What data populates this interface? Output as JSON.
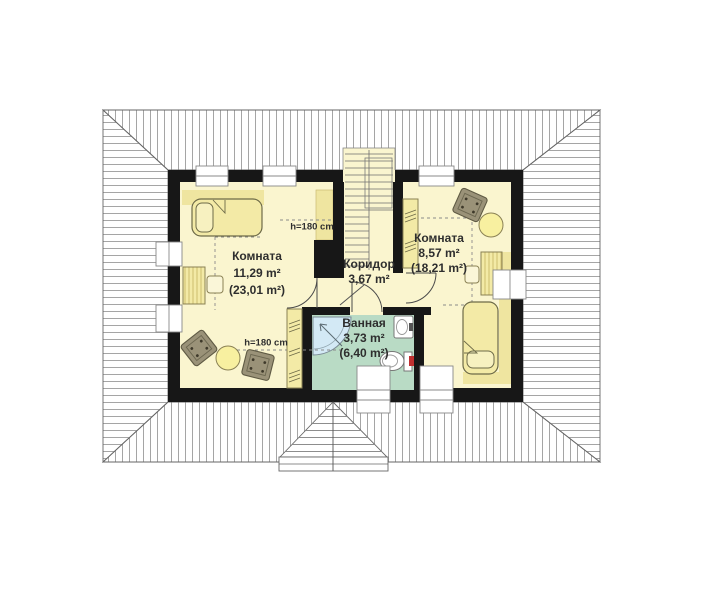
{
  "drawing": {
    "type": "attic floor plan",
    "language": "ru"
  },
  "rooms": [
    {
      "name": "Комната",
      "area": "11,29 m²",
      "total_area": "(23,01 m²)"
    },
    {
      "name": "Коридор",
      "area": "3,67 m²"
    },
    {
      "name": "Комната",
      "area": "8,57 m²",
      "total_area": "(18,21 m²)"
    },
    {
      "name": "Ванная",
      "area": "3,73 m²",
      "total_area": "(6,40 m²)"
    }
  ],
  "annotations": {
    "height_marker_top": "h=180 cm",
    "height_marker_bottom": "h=180 cm"
  },
  "furniture_icons": [
    "bed",
    "desk",
    "chair",
    "armchair",
    "round-table",
    "wardrobe",
    "staircase",
    "shower",
    "sink",
    "toilet",
    "door-arc",
    "window",
    "roof-dormer"
  ],
  "colors": {
    "floor": "#faf5cf",
    "low_ceiling_zone": "#efe5a0",
    "bathroom_floor": "#b9dbc5",
    "shower": "#d3e9f5",
    "walls": "#171717",
    "roof_lines": "#a5a5a5",
    "furniture_upholstery": "#9a9278",
    "furniture_wood": "#f3eaa6",
    "toilet_accent": "#c03030"
  }
}
